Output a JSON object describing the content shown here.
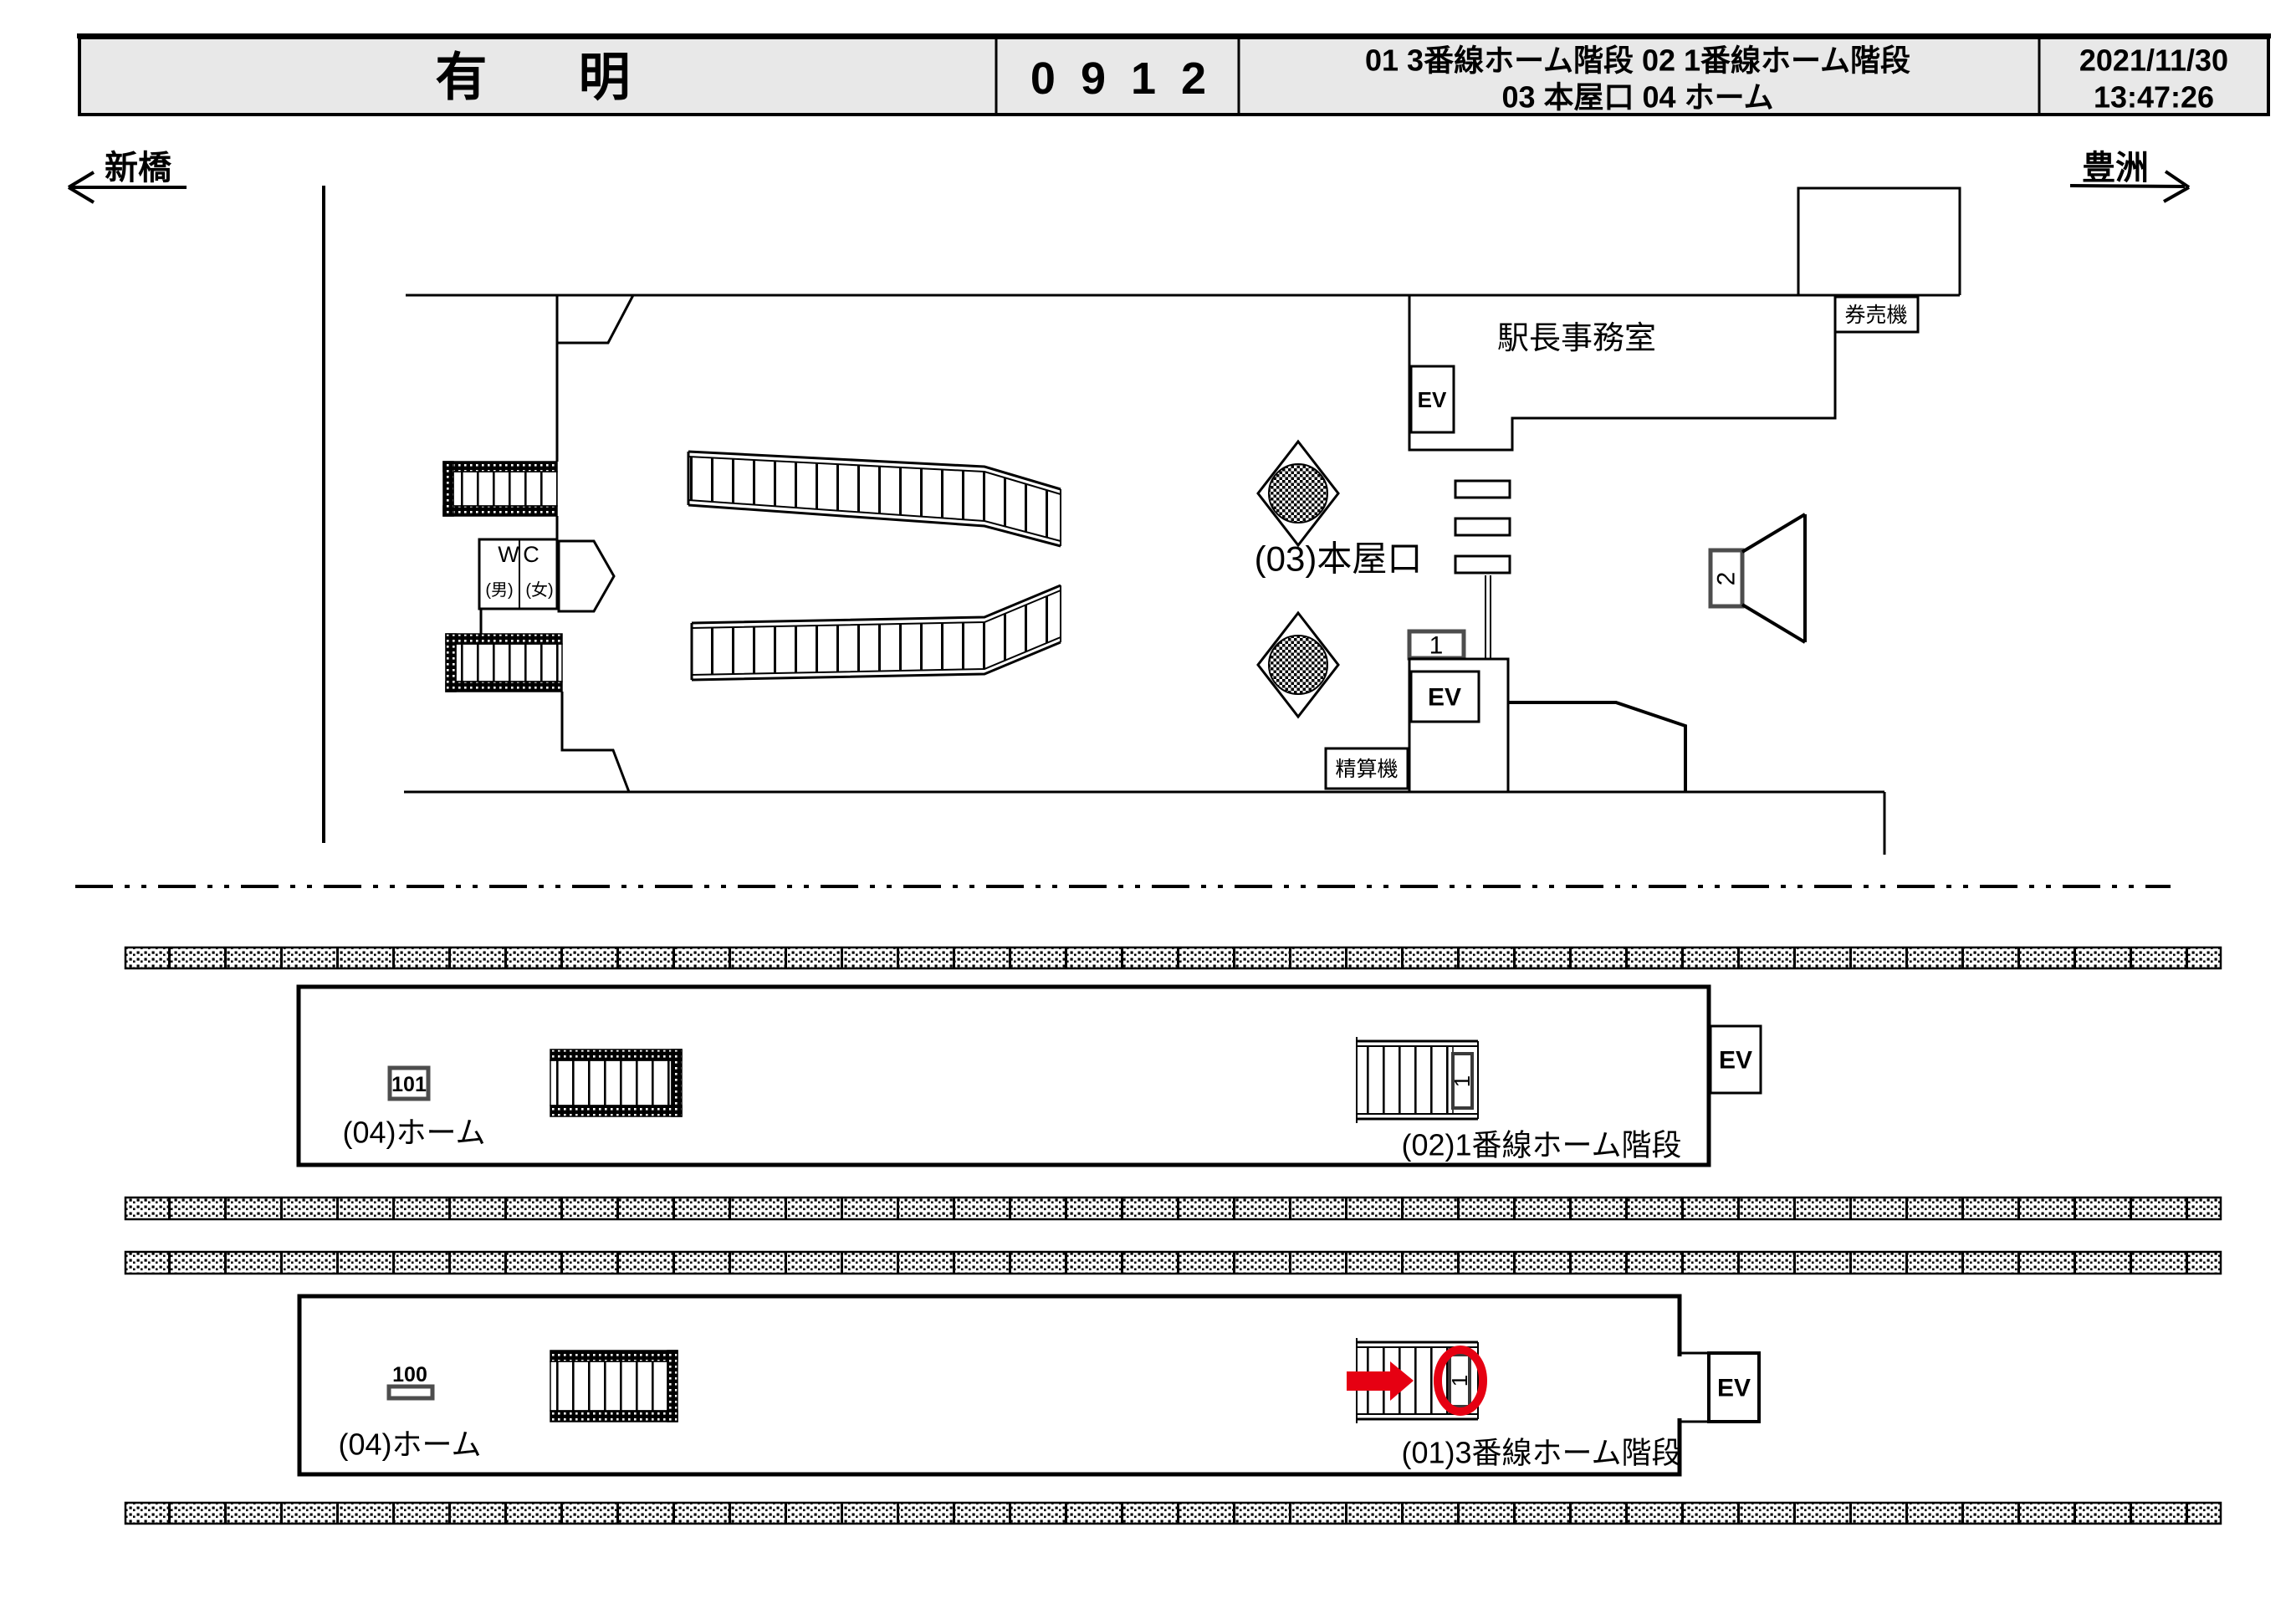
{
  "header": {
    "station_name": "有 明",
    "station_code": "0912",
    "cameras_row1": "01 3番線ホーム階段   02 1番線ホーム階段",
    "cameras_row2": "03 本屋口   04 ホーム",
    "date": "2021/11/30",
    "time": "13:47:26"
  },
  "directions": {
    "left": "新橋",
    "right": "豊洲"
  },
  "concourse": {
    "office_label": "駅長事務室",
    "ticket_machine_label": "券売機",
    "fare_adjust_label": "精算機",
    "exit_label": "(03)本屋口",
    "wc_w": "W",
    "wc_c": "C",
    "wc_male": "(男)",
    "wc_female": "(女)",
    "ev_label": "EV",
    "gate_marker": "1",
    "horn_marker": "2"
  },
  "platform1": {
    "position_marker": "101",
    "platform_label": "(04)ホーム",
    "stair_label": "(02)1番線ホーム階段",
    "stair_cam_marker": "1",
    "ev_label": "EV"
  },
  "platform2": {
    "position_marker": "100",
    "platform_label": "(04)ホーム",
    "stair_label": "(01)3番線ホーム階段",
    "stair_cam_marker": "1",
    "ev_label": "EV"
  },
  "colors": {
    "highlight_red": "#e60012",
    "header_bg": "#e8e8e8",
    "line": "#000000"
  }
}
